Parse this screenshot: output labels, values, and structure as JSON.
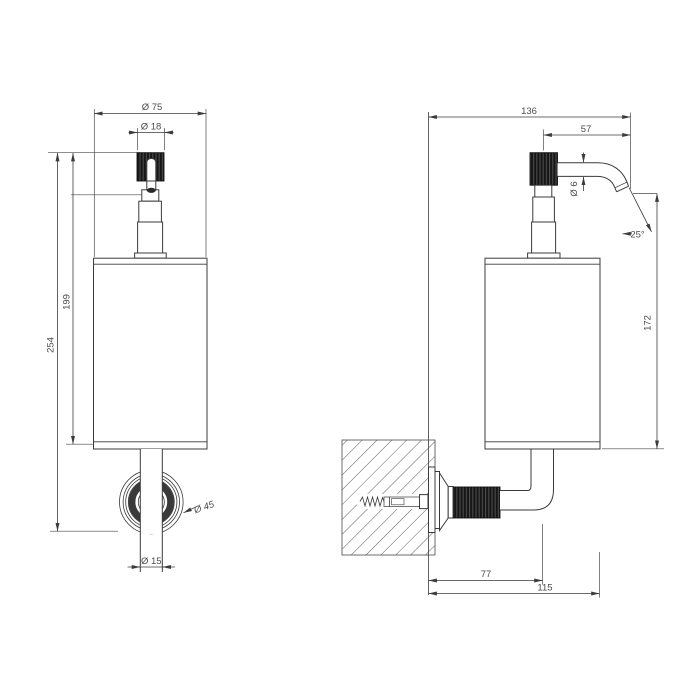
{
  "colors": {
    "background": "#ffffff",
    "line": "#3b3b3b",
    "dark_fill": "#161616",
    "text": "#4c4c4c"
  },
  "front_view": {
    "dim_body_diameter": "Ø 75",
    "dim_knob_diameter": "Ø 18",
    "dim_pump_height": "199",
    "dim_overall_height": "254",
    "dim_flange_diameter": "Ø 45",
    "dim_tube_diameter": "Ø 15"
  },
  "side_view": {
    "dim_overall_depth": "136",
    "dim_spout_reach": "57",
    "dim_spout_tube_diameter": "Ø 6",
    "dim_spout_angle": "25°",
    "dim_spout_to_base_height": "172",
    "dim_wall_to_tube_axis": "77",
    "dim_wall_to_body_front": "115"
  }
}
